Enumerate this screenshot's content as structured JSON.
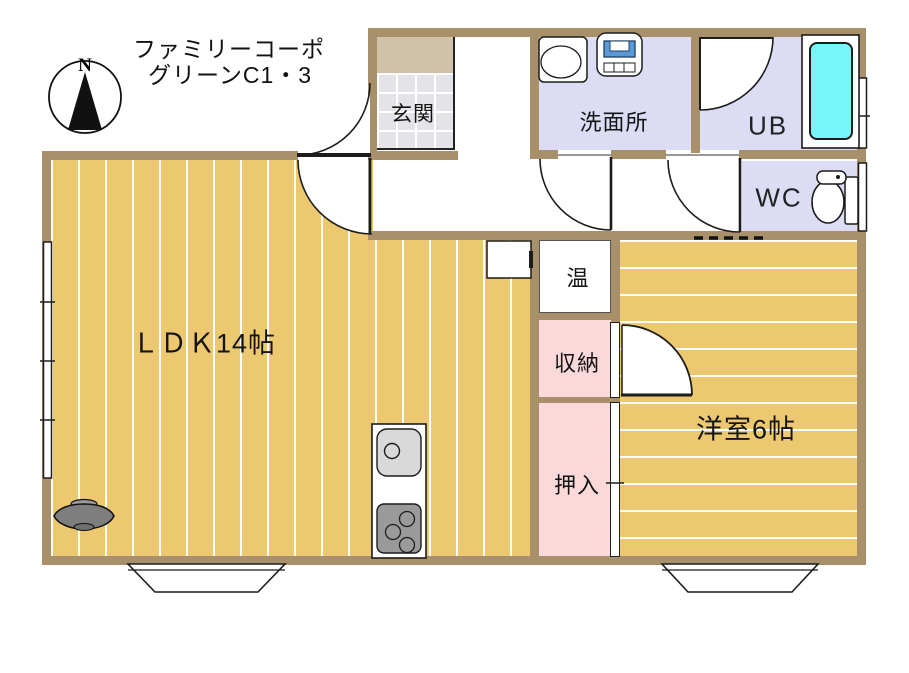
{
  "title": {
    "line1": "ファミリーコーポ",
    "line2": "グリーンC1・3"
  },
  "compass": {
    "north_label": "N"
  },
  "rooms": {
    "entrance": {
      "label": "玄関"
    },
    "washroom": {
      "label": "洗面所"
    },
    "unit_bath": {
      "label": "UB"
    },
    "toilet": {
      "label": "WC"
    },
    "water_heater": {
      "label": "温"
    },
    "storage": {
      "label": "収納"
    },
    "closet": {
      "label": "押入"
    },
    "living": {
      "label": "ＬＤＫ14帖"
    },
    "bedroom": {
      "label": "洋室6帖"
    }
  },
  "colors": {
    "wall": "#a8906a",
    "floor": "#ecc971",
    "wet_room": "#dcdcf5",
    "closet_pink": "#fbd9da",
    "bathtub": "#76f6f6",
    "tile": "#e4e4e8",
    "entrance_step": "#d0c2a8",
    "washer_blue": "#5b9bd5"
  }
}
